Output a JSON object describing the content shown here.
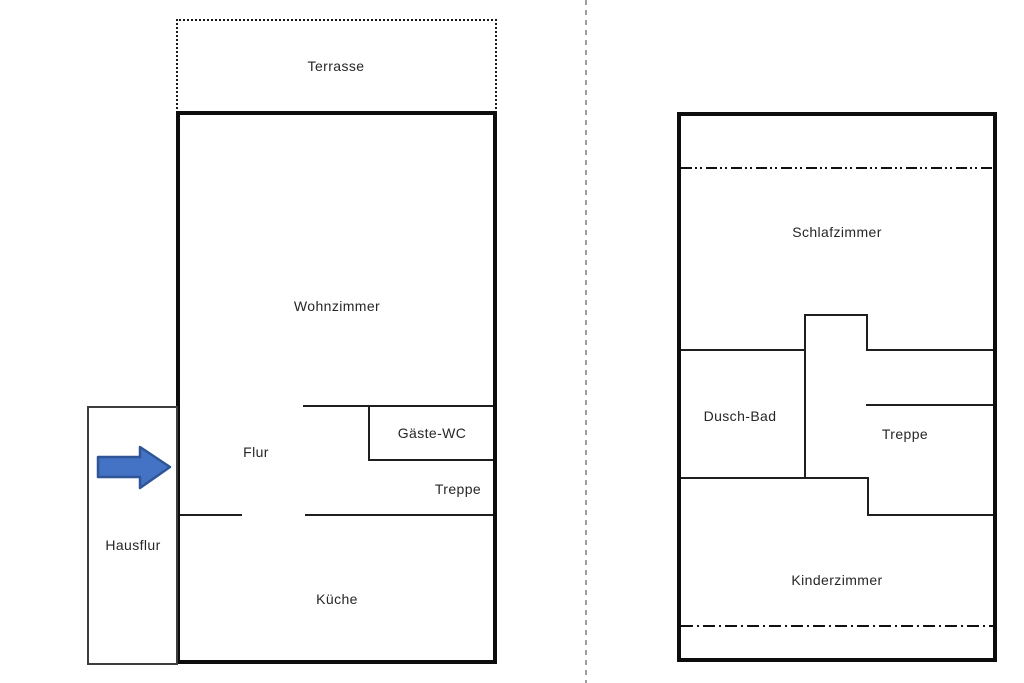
{
  "title": "Two-storey house floor plan",
  "ground_floor": {
    "terrasse_label": "Terrasse",
    "wohnzimmer_label": "Wohnzimmer",
    "flur_label": "Flur",
    "gaeste_wc_label": "Gäste-WC",
    "treppe_label": "Treppe",
    "hausflur_label": "Hausflur",
    "kueche_label": "Küche"
  },
  "upper_floor": {
    "schlafzimmer_label": "Schlafzimmer",
    "dusch_bad_label": "Dusch-Bad",
    "treppe_label": "Treppe",
    "kinderzimmer_label": "Kinderzimmer"
  },
  "colors": {
    "wall": "#1f1f1f",
    "outer_wall": "#0d0d0d",
    "text": "#262626",
    "divider": "#9e9e9e",
    "arrow_fill": "#4472c4",
    "arrow_stroke": "#2f5597",
    "background": "#ffffff"
  }
}
